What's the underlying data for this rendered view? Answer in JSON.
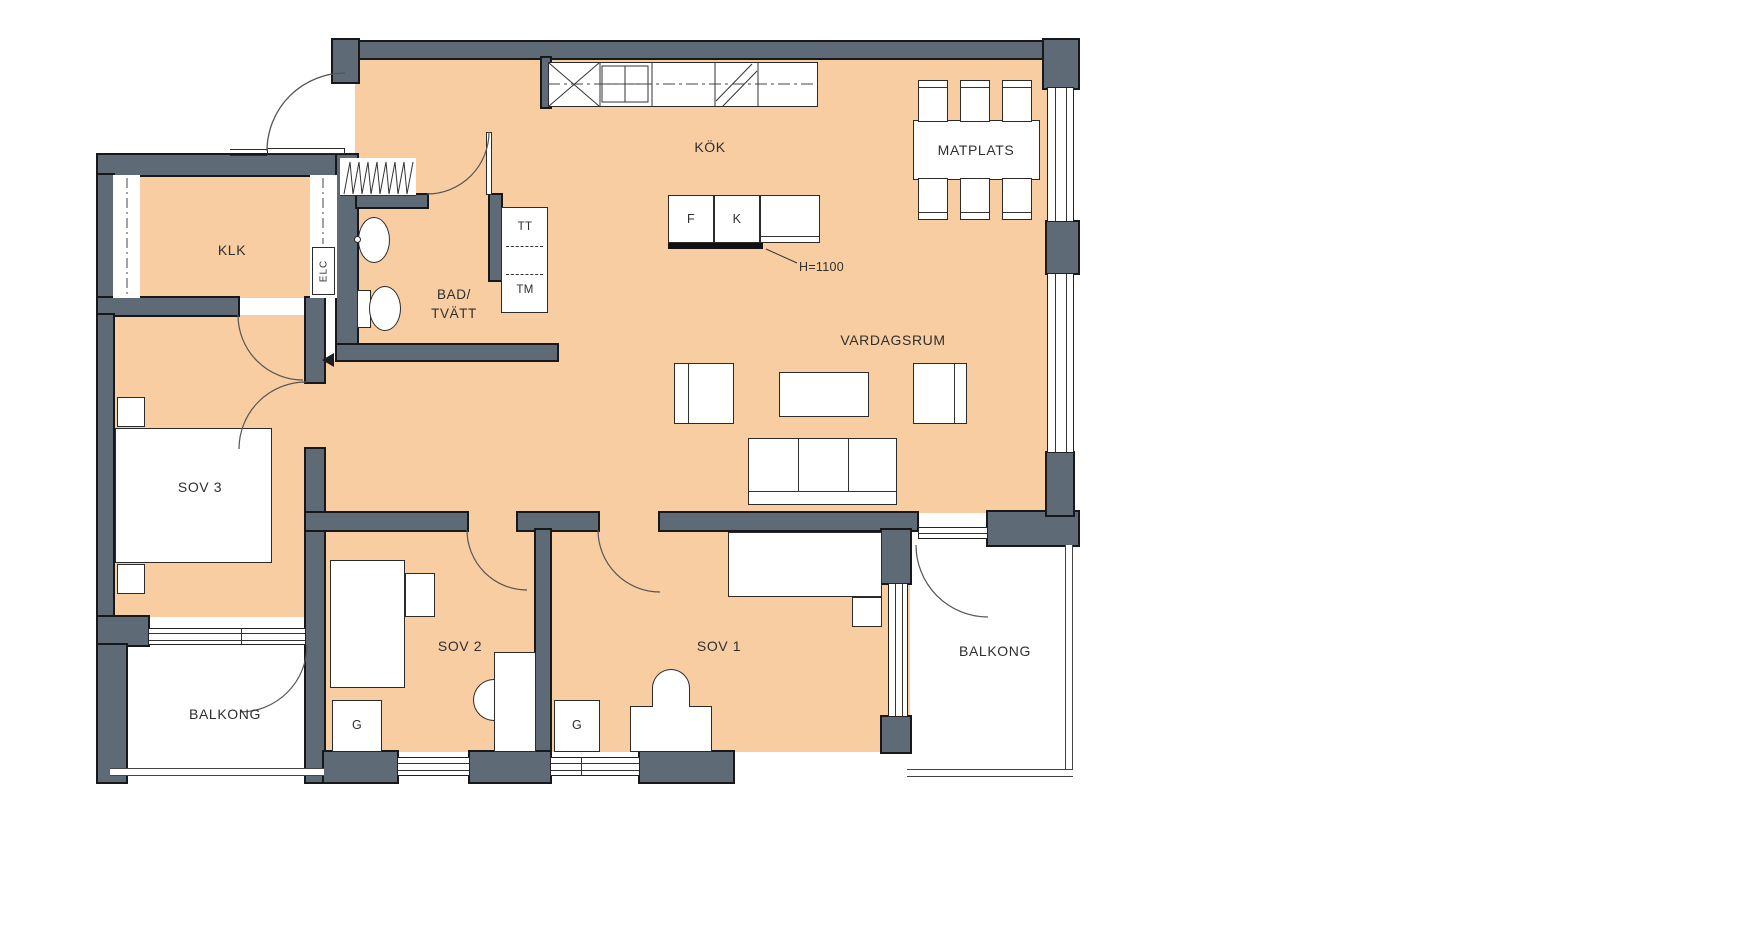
{
  "title": "Apartment floor plan",
  "labels": {
    "kok": "KÖK",
    "matplats": "MATPLATS",
    "vardagsrum": "VARDAGSRUM",
    "klk": "KLK",
    "bad_line1": "BAD/",
    "bad_line2": "TVÄTT",
    "sov3": "SOV 3",
    "sov2": "SOV 2",
    "sov1": "SOV 1",
    "balkong_left": "BALKONG",
    "balkong_right": "BALKONG",
    "g_sov2": "G",
    "g_sov1": "G",
    "freezer": "F",
    "fridge": "K",
    "tumble_dryer": "TT",
    "washing_machine": "TM",
    "counter_height": "H=1100",
    "el_cabinet": "ELC"
  },
  "colors": {
    "floor": "#f8cda2",
    "wall": "#5e6a75",
    "wall_outline": "#16181a",
    "line": "#2f2f2f",
    "background": "#ffffff"
  }
}
